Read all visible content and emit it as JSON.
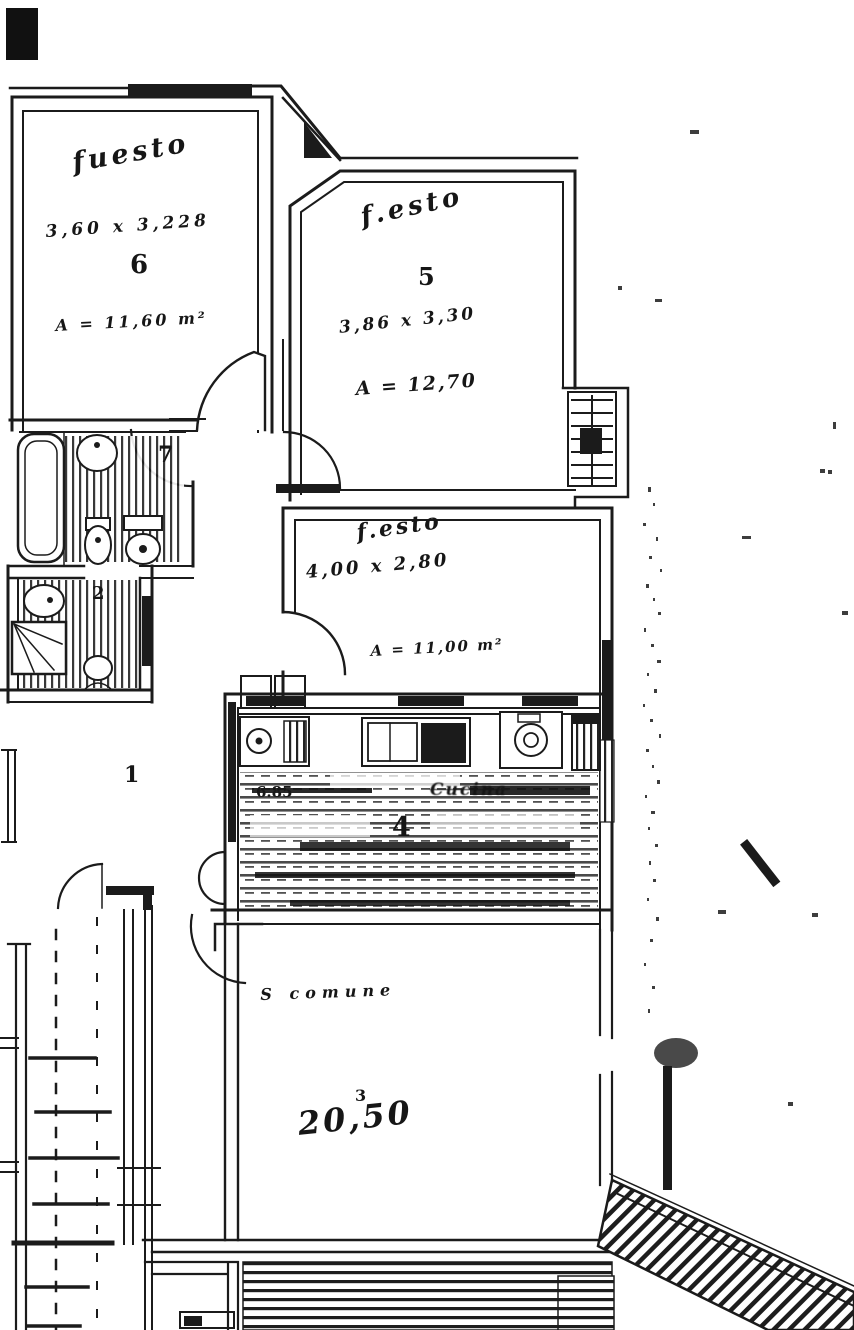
{
  "page": {
    "background": "#ffffff",
    "ink": "#1b1b1b"
  },
  "rooms": {
    "bedroom1": {
      "name": "fuesto",
      "dims": "3,60 x 3,228",
      "number": "6",
      "area": "A = 11,60 m²"
    },
    "bedroom2": {
      "name": "f.esto",
      "number": "5",
      "dims": "3,86 x 3,30",
      "area": "A = 12,70"
    },
    "bedroom3": {
      "name": "f.esto",
      "dims": "4,00 x 2,80",
      "area": "A = 11,00 m²"
    },
    "kitchen": {
      "width_label": "6.85",
      "name": "Cucina",
      "number": "4"
    },
    "living": {
      "name": "S comune",
      "number": "3",
      "area": "20,50"
    }
  },
  "labels": {
    "bath1": "7",
    "bath2": "2",
    "hall": "1"
  },
  "specks": [
    [
      648,
      487,
      3,
      5
    ],
    [
      653,
      503,
      2,
      3
    ],
    [
      643,
      523,
      3,
      3
    ],
    [
      656,
      537,
      2,
      4
    ],
    [
      649,
      556,
      3,
      3
    ],
    [
      660,
      569,
      2,
      3
    ],
    [
      646,
      584,
      3,
      4
    ],
    [
      653,
      598,
      2,
      3
    ],
    [
      658,
      612,
      3,
      3
    ],
    [
      644,
      628,
      2,
      4
    ],
    [
      651,
      644,
      3,
      3
    ],
    [
      657,
      660,
      4,
      3
    ],
    [
      647,
      673,
      2,
      3
    ],
    [
      654,
      689,
      3,
      4
    ],
    [
      643,
      704,
      2,
      3
    ],
    [
      650,
      719,
      3,
      3
    ],
    [
      659,
      734,
      2,
      4
    ],
    [
      646,
      749,
      3,
      3
    ],
    [
      652,
      765,
      2,
      3
    ],
    [
      657,
      780,
      3,
      4
    ],
    [
      645,
      795,
      2,
      3
    ],
    [
      651,
      811,
      4,
      3
    ],
    [
      648,
      827,
      2,
      3
    ],
    [
      655,
      844,
      3,
      3
    ],
    [
      649,
      861,
      2,
      4
    ],
    [
      653,
      879,
      3,
      3
    ],
    [
      647,
      898,
      2,
      3
    ],
    [
      656,
      917,
      3,
      4
    ],
    [
      650,
      939,
      3,
      3
    ],
    [
      644,
      963,
      2,
      3
    ],
    [
      652,
      986,
      3,
      3
    ],
    [
      648,
      1009,
      2,
      4
    ],
    [
      690,
      130,
      9,
      4
    ],
    [
      820,
      469,
      5,
      4
    ],
    [
      828,
      470,
      4,
      4
    ],
    [
      742,
      536,
      9,
      3
    ],
    [
      618,
      286,
      4,
      4
    ],
    [
      655,
      299,
      7,
      3
    ],
    [
      842,
      611,
      6,
      4
    ],
    [
      718,
      910,
      8,
      4
    ],
    [
      812,
      913,
      6,
      4
    ],
    [
      788,
      1102,
      5,
      4
    ],
    [
      833,
      422,
      3,
      7
    ]
  ]
}
